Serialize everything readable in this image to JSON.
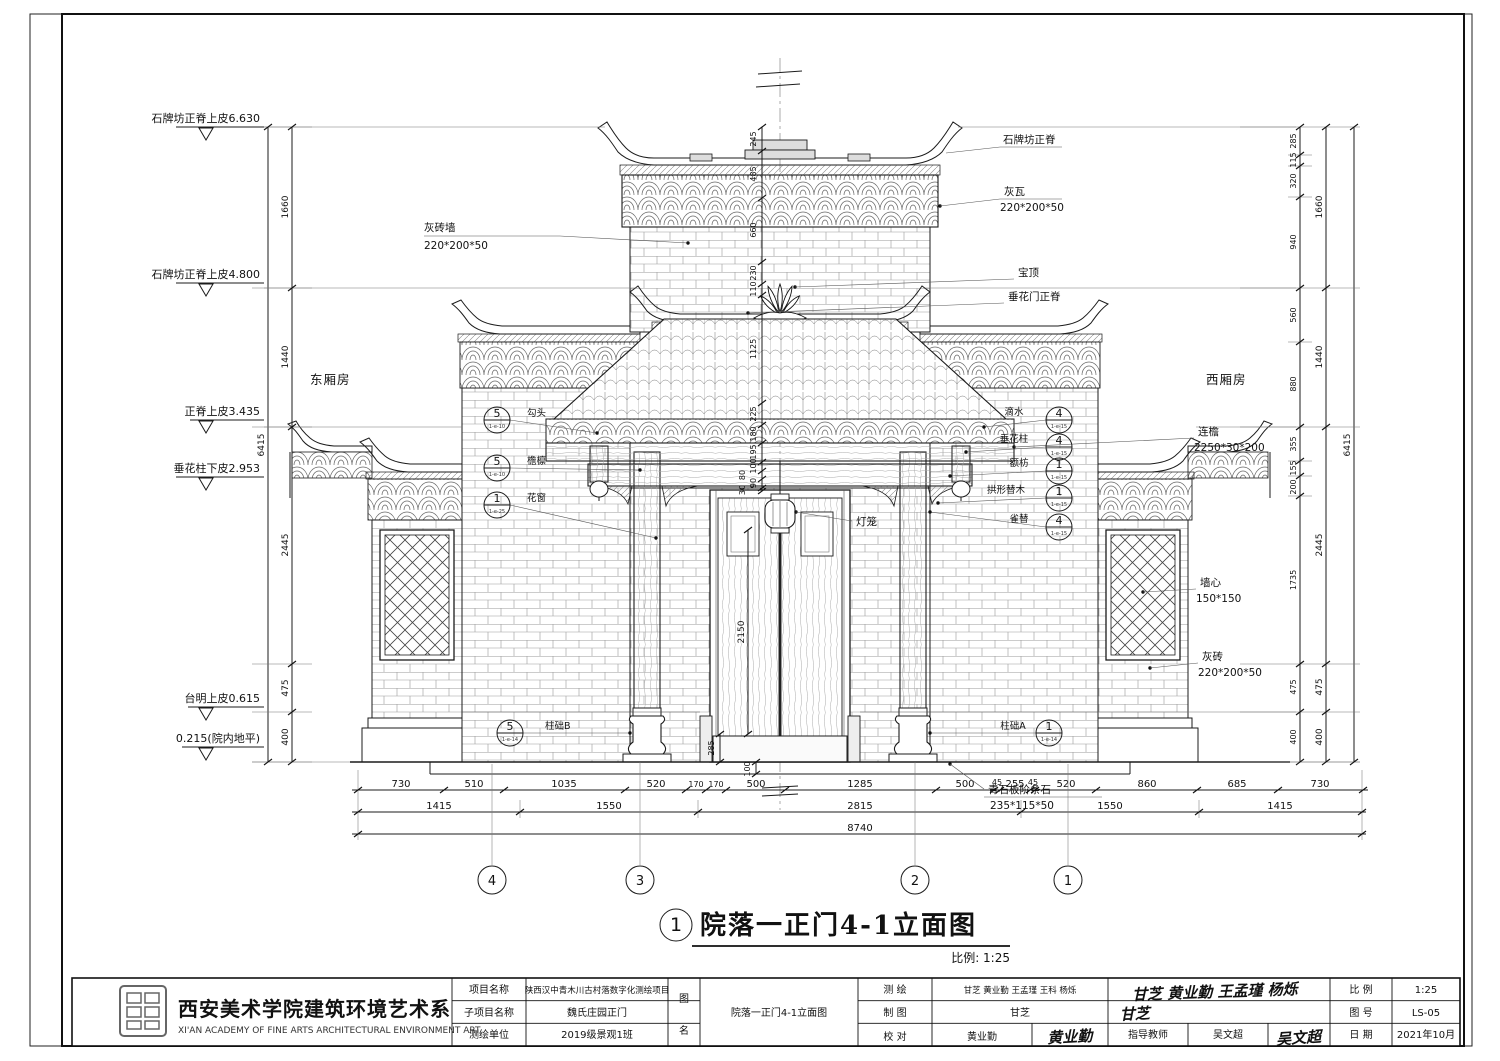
{
  "sheet": {
    "title_no": "1",
    "title": "院落一正门4-1立面图",
    "scale_note": "比例: 1:25"
  },
  "rooms": {
    "east": "东厢房",
    "west": "西厢房"
  },
  "levels": [
    "石牌坊正脊上皮6.630",
    "石牌坊正脊上皮4.800",
    "正脊上皮3.435",
    "垂花柱下皮2.953",
    "台明上皮0.615",
    "0.215(院内地平)"
  ],
  "dims": {
    "left_segments": [
      "1660",
      "1440",
      "2445",
      "475",
      "400"
    ],
    "left_total": "6415",
    "right_inner": [
      "285",
      "115",
      "320",
      "940",
      "560",
      "880",
      "355",
      "155",
      "200",
      "1735",
      "475",
      "400"
    ],
    "right_mid": [
      "1660",
      "1440",
      "2445",
      "475",
      "400"
    ],
    "right_total": "6415",
    "center": [
      "245",
      "485",
      "660",
      "230",
      "110",
      "1125",
      "225",
      "180",
      "195",
      "100",
      "80",
      "90",
      "30"
    ],
    "door_height": "2150",
    "threshold": "285",
    "step": "100",
    "bottom_row1": [
      "730",
      "510",
      "1035",
      "520",
      "170",
      "170",
      "500",
      "1285",
      "500",
      "45",
      "255",
      "45",
      "520",
      "860",
      "685",
      "730"
    ],
    "bottom_row2": [
      "1415",
      "1550",
      "2815",
      "1550",
      "1415"
    ],
    "bottom_total": "8740"
  },
  "grid": [
    "4",
    "3",
    "2",
    "1"
  ],
  "labels": {
    "brick_wall": {
      "name": "灰砖墙",
      "spec": "220*200*50"
    },
    "ridge_top": "石牌坊正脊",
    "grey_tile": {
      "name": "灰瓦",
      "spec": "220*200*50"
    },
    "baoding": "宝顶",
    "ridge_mid": "垂花门正脊",
    "lianyan": {
      "name": "连檐",
      "spec": "2250*30*200"
    },
    "wall_core": {
      "name": "墙心",
      "spec": "150*150"
    },
    "grey_brick": {
      "name": "灰砖",
      "spec": "220*200*50"
    },
    "stone": {
      "name": "青石板阶条石",
      "spec": "235*115*50"
    },
    "lantern": "灯笼"
  },
  "callouts": {
    "goutou": {
      "num": "5",
      "ref": "1-e-10",
      "label": "勾头"
    },
    "yanlin": {
      "num": "5",
      "ref": "1-e-10",
      "label": "檐檩"
    },
    "huachuang": {
      "num": "1",
      "ref": "1-e-25",
      "label": "花窗"
    },
    "zhuchB": {
      "num": "5",
      "ref": "1-e-14",
      "label": "柱础B"
    },
    "dishui": {
      "num": "4",
      "ref": "1-e-15",
      "label": "滴水"
    },
    "chuihuazhu": {
      "num": "4",
      "ref": "1-e-15",
      "label": "垂花柱"
    },
    "efang": {
      "num": "1",
      "ref": "1-e-15",
      "label": "额枋"
    },
    "gongxtimu": {
      "num": "1",
      "ref": "1-e-15",
      "label": "拱形替木"
    },
    "queti": {
      "num": "4",
      "ref": "1-e-15",
      "label": "雀替"
    },
    "zhuchA": {
      "num": "1",
      "ref": "1-e-14",
      "label": "柱础A"
    }
  },
  "titleblock": {
    "org_cn": "西安美术学院建筑环境艺术系",
    "org_en": "XI'AN ACADEMY OF FINE ARTS ARCHITECTURAL ENVIRONMENT ART",
    "project_label": "项目名称",
    "project": "陕西汉中青木川古村落数字化测绘项目",
    "subproject_label": "子项目名称",
    "subproject": "魏氏庄园正门",
    "unit_label": "测绘单位",
    "unit": "2019级景观1班",
    "fig_label_1": "图",
    "fig_label_2": "名",
    "fig_name": "院落一正门4-1立面图",
    "survey_label": "测  绘",
    "survey": "甘芝  黄业勤  王孟瑾  王科  杨烁",
    "draft_label": "制  图",
    "draft": "甘芝",
    "check_label": "校  对",
    "check": "黄业勤",
    "advisor_label": "指导教师",
    "advisor": "吴文超",
    "sig_survey": "甘芝 黄业勤 王孟瑾 杨烁",
    "sig_draft": "甘芝",
    "sig_check": "黄业勤",
    "sig_advisor": "吴文超",
    "scale_label": "比  例",
    "scale": "1:25",
    "no_label": "图  号",
    "no": "LS-05",
    "date_label": "日  期",
    "date": "2021年10月"
  }
}
